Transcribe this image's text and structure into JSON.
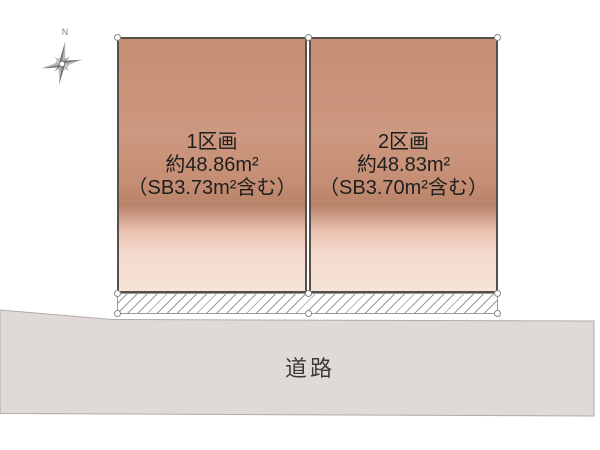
{
  "diagram": {
    "compass_label": "N",
    "plots": [
      {
        "name": "1区画",
        "area": "約48.86m²",
        "note": "（SB3.73m²含む）"
      },
      {
        "name": "2区画",
        "area": "約48.83m²",
        "note": "（SB3.70m²含む）"
      }
    ],
    "road_label": "道路",
    "colors": {
      "plot_fill_top": "#c68d74",
      "plot_fill_dark_band": "#b8836a",
      "plot_fill_bottom": "#f7e3d8",
      "plot_border": "#57504a",
      "hatch_line": "#9a9a9a",
      "road_fill": "#e0dad7",
      "road_border": "#b2aaa6",
      "compass_gray": "#8a8a8a",
      "text_color": "#1e1e1e"
    }
  }
}
